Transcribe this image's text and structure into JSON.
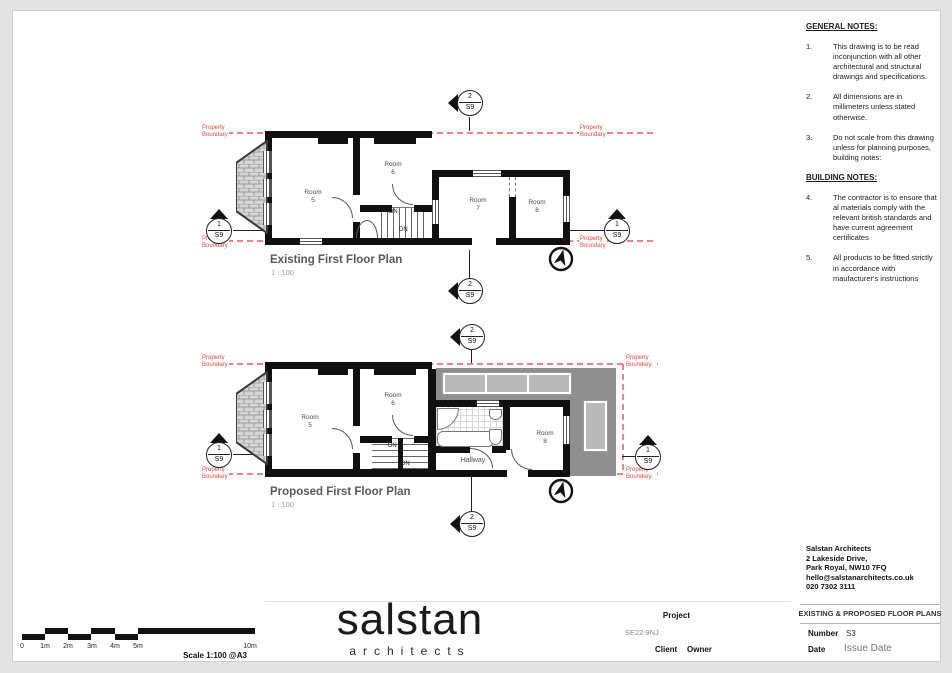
{
  "notes": {
    "general_title": "GENERAL NOTES:",
    "general": [
      {
        "num": "1.",
        "text": "This drawing is to be read inconjunction with all other architectural and structural drawings and specifications."
      },
      {
        "num": "2.",
        "text": "All dimensions are in millimeters unless stated otherwise."
      },
      {
        "num": "3.",
        "text": "Do not scale from this drawing unless for planning purposes, building notes:"
      }
    ],
    "building_title": "BUILDING NOTES:",
    "building": [
      {
        "num": "4.",
        "text": "The contractor is to ensure that al materials comply with the relevant british standards and have current agreement certificates"
      },
      {
        "num": "5.",
        "text": "All products to be fitted strictly in accordance with maufacturer's instructions"
      }
    ]
  },
  "markers": {
    "num1": "1",
    "num2": "2",
    "sheet": "S9"
  },
  "boundary": {
    "line1": "Property",
    "line2": "Boundary"
  },
  "plans": {
    "existing": {
      "title": "Existing First Floor Plan",
      "scale": "1 : 100",
      "dn": "DN",
      "rooms": [
        {
          "name": "Room",
          "num": "5"
        },
        {
          "name": "Room",
          "num": "6"
        },
        {
          "name": "Room",
          "num": "7"
        },
        {
          "name": "Room",
          "num": "8"
        }
      ]
    },
    "proposed": {
      "title": "Proposed First Floor Plan",
      "scale": "1 : 100",
      "dn": "DN",
      "hallway": "Hallway",
      "rooms": [
        {
          "name": "Room",
          "num": "5"
        },
        {
          "name": "Room",
          "num": "6"
        },
        {
          "name": "Room",
          "num": "8"
        }
      ]
    }
  },
  "scalebar": {
    "ticks": [
      "0",
      "1m",
      "2m",
      "3m",
      "4m",
      "5m",
      "10m"
    ],
    "caption": "Scale 1:100 @A3"
  },
  "logo": {
    "name": "salstan",
    "sub": "architects"
  },
  "project": {
    "label": "Project",
    "value": "SE22 9NJ",
    "client_label": "Client",
    "client_value": "Owner"
  },
  "firm": {
    "name": "Salstan Architects",
    "address1": "2 Lakeside Drive,",
    "address2": "Park Royal, NW10 7FQ",
    "email": "hello@salstanarchitects.co.uk",
    "phone": "020 7302 3111"
  },
  "titleblock": {
    "sheet_title": "EXISTING & PROPOSED FLOOR PLANS",
    "number_label": "Number",
    "number_value": "S3",
    "date_label": "Date",
    "date_value": "Issue Date"
  },
  "colors": {
    "boundary_red": "#e05050",
    "roof_gray": "#8f8f8f"
  }
}
